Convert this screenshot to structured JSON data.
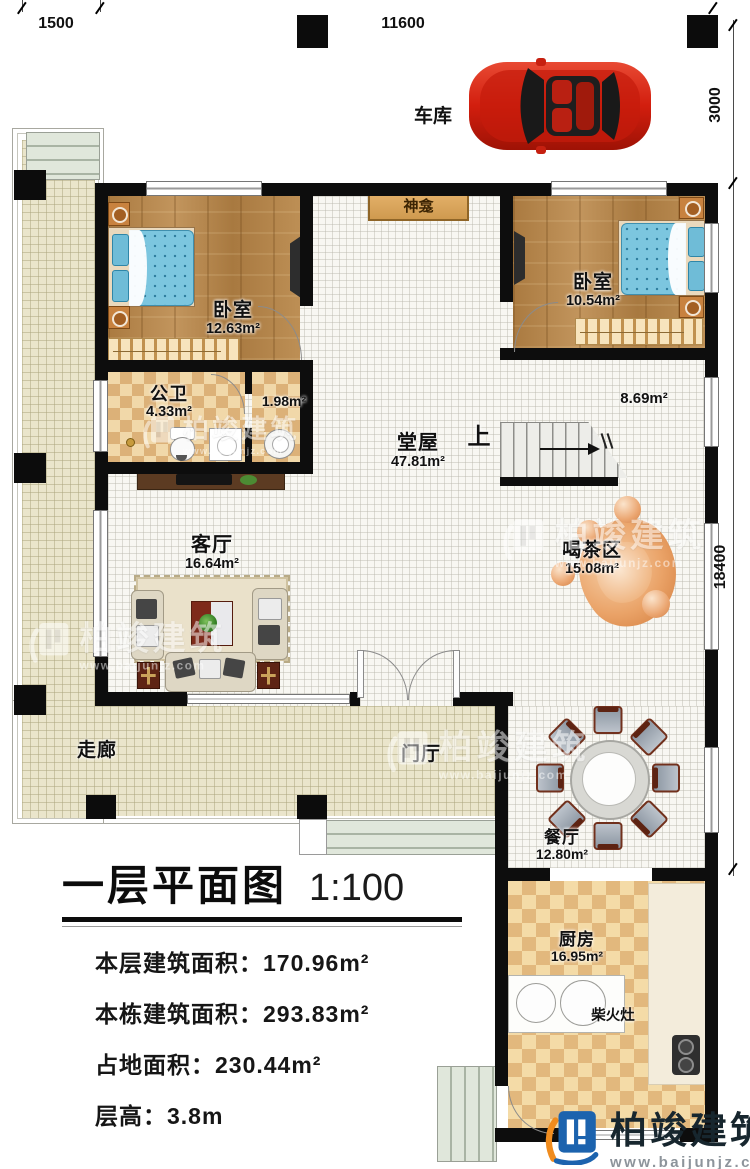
{
  "brand": {
    "name": "柏竣建筑",
    "url": "www.baijunjz.com"
  },
  "garage": {
    "label": "车库"
  },
  "dimensions": {
    "porch_width": "1500",
    "building_width": "11600",
    "garage_depth": "3000",
    "building_depth": "18400"
  },
  "rooms": {
    "bedroom_left": {
      "name": "卧室",
      "area": "12.63m²"
    },
    "bedroom_right": {
      "name": "卧室",
      "area": "10.54m²"
    },
    "bathroom": {
      "name": "公卫",
      "area": "4.33m²"
    },
    "wash_area": {
      "area": "1.98m²"
    },
    "hall": {
      "name": "堂屋",
      "area": "47.81m²"
    },
    "stair_zone": {
      "area": "8.69m²"
    },
    "living_room": {
      "name": "客厅",
      "area": "16.64m²"
    },
    "tea_area": {
      "name": "喝茶区",
      "area": "15.08m²"
    },
    "corridor": {
      "name": "走廊"
    },
    "foyer": {
      "name": "门厅"
    },
    "dining_room": {
      "name": "餐厅",
      "area": "12.80m²"
    },
    "kitchen": {
      "name": "厨房",
      "area": "16.95m²"
    },
    "shrine": {
      "name": "神龛"
    },
    "stove": {
      "name": "柴火灶"
    },
    "stairs_up": {
      "label": "上"
    }
  },
  "title_block": {
    "title": "一层平面图",
    "scale": "1:100",
    "rows": [
      "本层建筑面积：170.96m²",
      "本栋建筑面积：293.83m²",
      "占地面积：230.44m²",
      "层高：3.8m"
    ]
  },
  "colors": {
    "wall": "#0d0d0d",
    "wood_floor": "#b5854c",
    "checker_dark": "#dcb178",
    "corridor_floor": "#eae5cb",
    "bed_blue": "#7cc6df",
    "tea_orange": "#e8a468",
    "brand_blue": "#1c63ae",
    "brand_orange": "#f08c1e",
    "brand_text": "#17262e"
  }
}
